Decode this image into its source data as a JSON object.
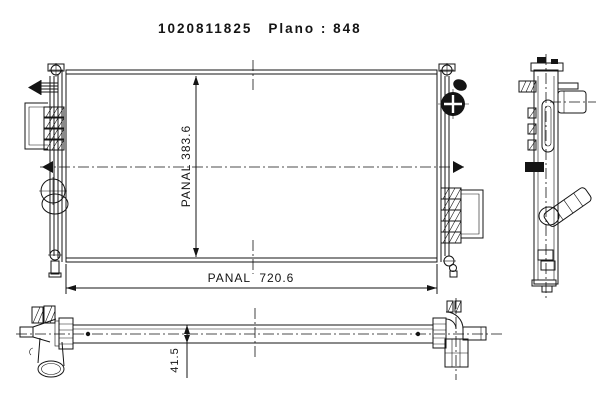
{
  "title": {
    "part_number": "1020811825",
    "plano": "Plano : 848"
  },
  "front_view": {
    "height_dim_label": "PANAL 383.6",
    "width_dim_label": "PANAL  720.6"
  },
  "bottom_view": {
    "thickness_dim_label": "41.5"
  },
  "colors": {
    "line": "#141414",
    "background": "#ffffff"
  }
}
